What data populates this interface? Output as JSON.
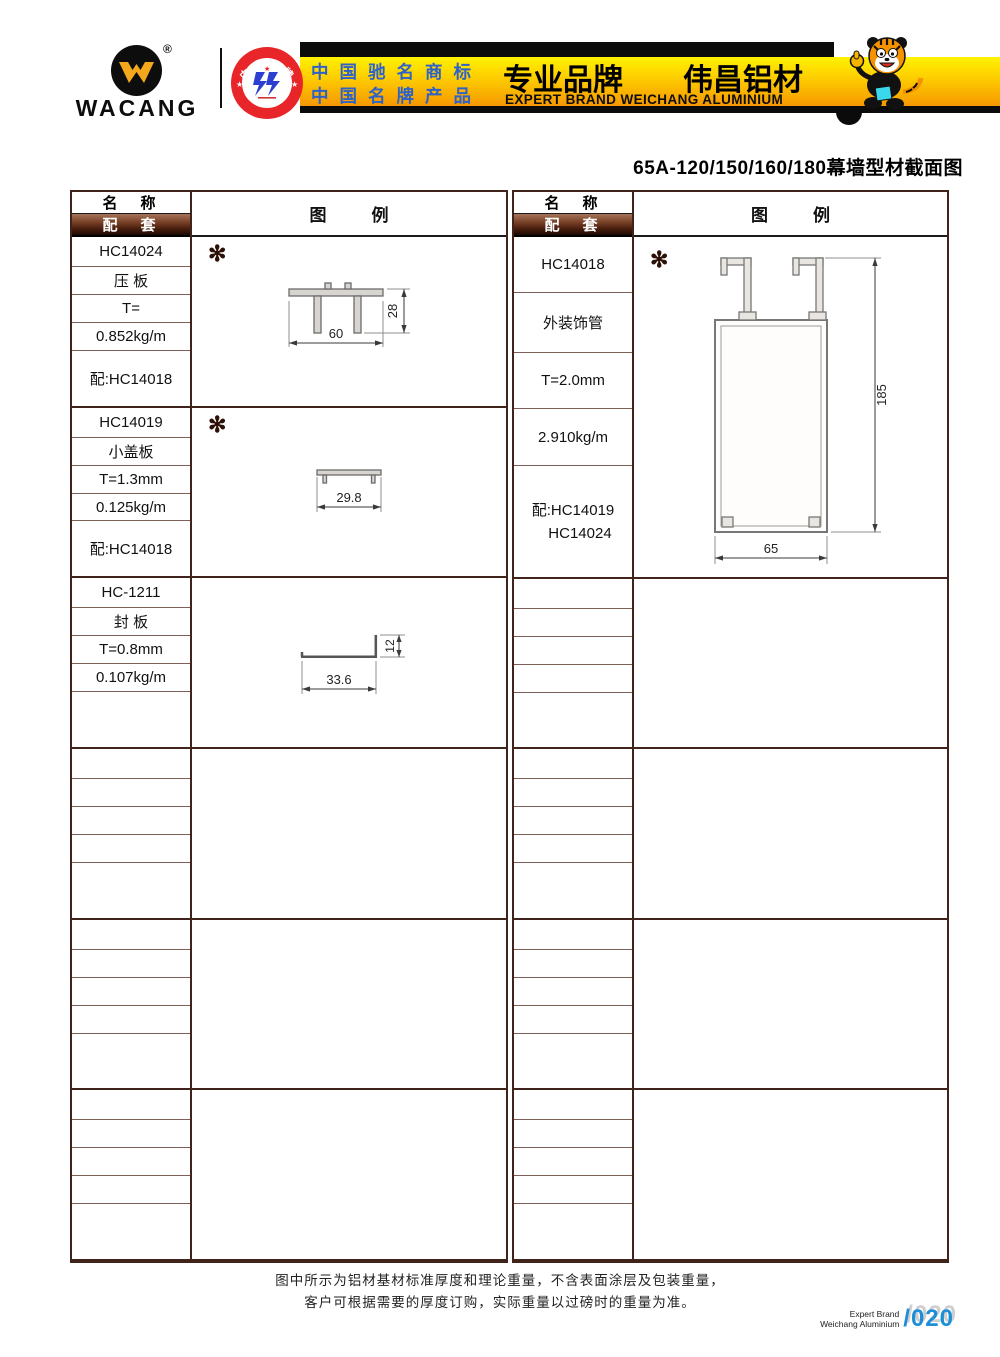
{
  "header": {
    "logo": {
      "text": "WACANG",
      "registered": "®"
    },
    "badge": {
      "arc_top": "中国名牌",
      "arc_bottom": "CHINA TOP BRAND"
    },
    "claim_line1": "中国驰名商标",
    "claim_line2": "中国名牌产品",
    "brand_cn": "专业品牌　　伟昌铝材",
    "brand_en": "EXPERT BRAND WEICHANG ALUMINIUM"
  },
  "page_title": "65A-120/150/160/180幕墙型材截面图",
  "table_headers": {
    "name": "名　称",
    "match": "配　套",
    "legend": "图　例"
  },
  "legend_mark": "✻",
  "left_table": {
    "blocks": [
      {
        "code": "HC14024",
        "name": "压 板",
        "thickness": "T=",
        "weight": "0.852kg/m",
        "match": "配:HC14018"
      },
      {
        "code": "HC14019",
        "name": "小盖板",
        "thickness": "T=1.3mm",
        "weight": "0.125kg/m",
        "match": "配:HC14018"
      },
      {
        "code": "HC-1211",
        "name": "封 板",
        "thickness": "T=0.8mm",
        "weight": "0.107kg/m",
        "match": ""
      },
      {
        "code": "",
        "name": "",
        "thickness": "",
        "weight": "",
        "match": ""
      },
      {
        "code": "",
        "name": "",
        "thickness": "",
        "weight": "",
        "match": ""
      },
      {
        "code": "",
        "name": "",
        "thickness": "",
        "weight": "",
        "match": ""
      }
    ]
  },
  "right_table": {
    "block": {
      "code": "HC14018",
      "name": "外装饰管",
      "thickness": "T=2.0mm",
      "weight": "2.910kg/m",
      "match_line1": "配:HC14019",
      "match_line2": "HC14024"
    }
  },
  "drawings": {
    "hc14024": {
      "width_label": "60",
      "height_label": "28"
    },
    "hc14019": {
      "width_label": "29.8"
    },
    "hc1211": {
      "width_label": "33.6",
      "height_label": "12"
    },
    "hc14018": {
      "width_label": "65",
      "height_label": "185"
    }
  },
  "footer": {
    "note_line1": "图中所示为铝材基材标准厚度和理论重量，不含表面涂层及包装重量，",
    "note_line2": "客户可根据需要的厚度订购，实际重量以过磅时的重量为准。",
    "brand_small_line1": "Expert Brand",
    "brand_small_line2": "Weichang Aluminium",
    "page_number": "/020"
  },
  "colors": {
    "banner_gold_top": "#fff200",
    "banner_gold_bottom": "#f59200",
    "header_row_brown": "#451c0d",
    "table_line": "#7d5f55",
    "badge_red": "#e8262a",
    "claim_blue": "#2e62c8",
    "page_number_blue": "#1d8fd8"
  }
}
